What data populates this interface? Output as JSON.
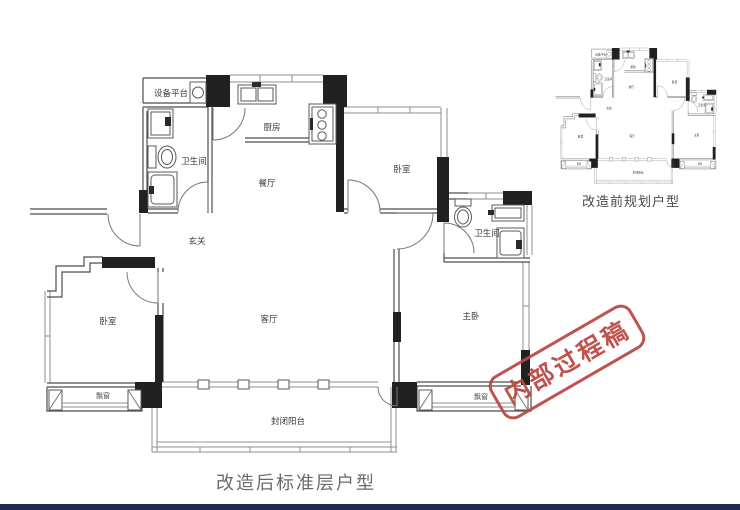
{
  "captions": {
    "main_plan": "改造后标准层户型",
    "mini_plan": "改造前规划户型"
  },
  "stamp": {
    "text": "内部过程稿",
    "color": "#bc4742"
  },
  "rooms": {
    "equipment_platform": "设备平台",
    "bathroom_left": "卫生间",
    "kitchen": "厨房",
    "dining_room": "餐厅",
    "foyer": "玄关",
    "bedroom_top_right": "卧室",
    "bedroom_left": "卧室",
    "living_room": "客厅",
    "master_bedroom": "主卧",
    "bathroom_right": "卫生间",
    "bay_window_left": "飘窗",
    "bay_window_right": "飘窗",
    "balcony": "封闭阳台"
  },
  "colors": {
    "bottom_bar": "#1c2b4d",
    "wall_line": "#4d4d4d",
    "solid_wall": "#212121"
  }
}
